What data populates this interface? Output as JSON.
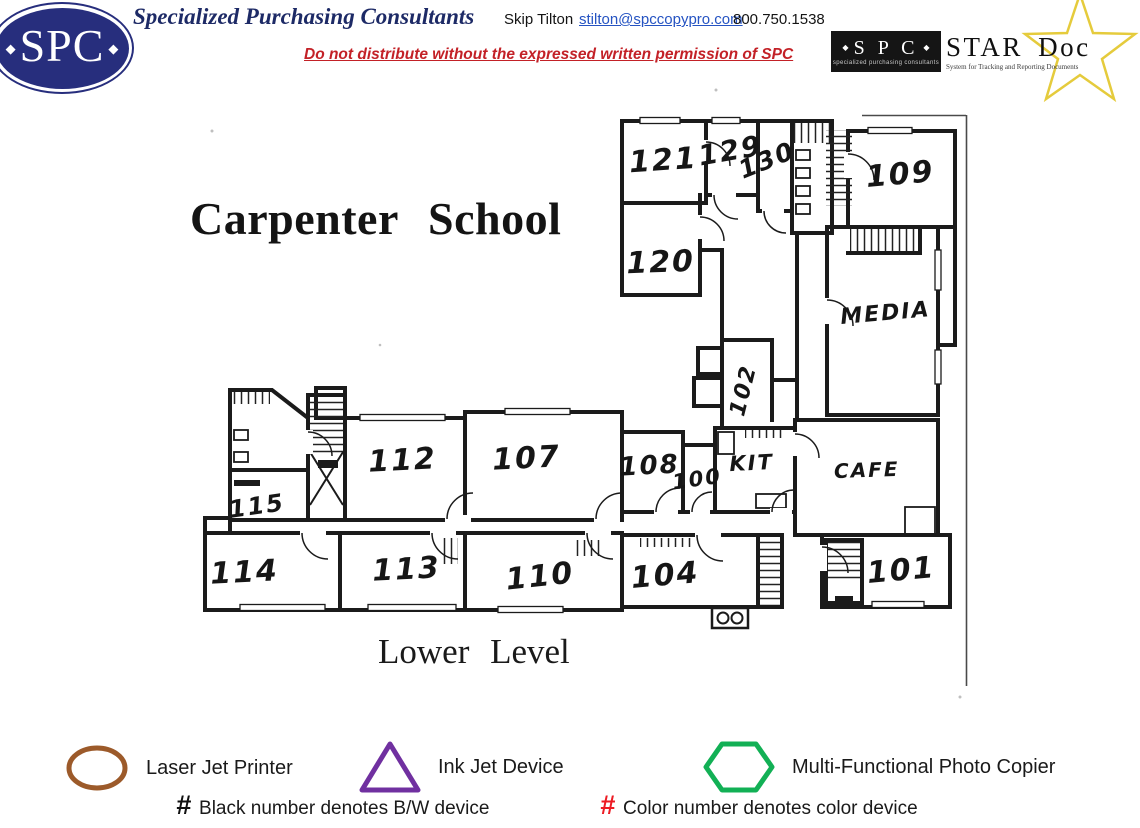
{
  "header": {
    "logo_text": "SPC",
    "company": "Specialized Purchasing Consultants",
    "contact": {
      "name": "Skip Tilton",
      "email": "stilton@spccopypro.com",
      "phone": "800.750.1538"
    },
    "warning": "Do not distribute without the expressed written permission of SPC",
    "stardoc": {
      "box_text": "S P C",
      "box_subtext": "specialized purchasing consultants",
      "title": "STAR Doc",
      "subtitle": "System for Tracking and Reporting Documents",
      "star_color": "#e5cb3c"
    }
  },
  "floorplan": {
    "title": "Carpenter School",
    "level": "Lower Level",
    "rooms": [
      {
        "label": "121",
        "x": 664,
        "y": 170,
        "rot": -4,
        "size": 30
      },
      {
        "label": "129",
        "x": 732,
        "y": 160,
        "rot": -10,
        "size": 28
      },
      {
        "label": "130",
        "x": 770,
        "y": 168,
        "rot": -22,
        "size": 25
      },
      {
        "label": "109",
        "x": 901,
        "y": 184,
        "rot": -5,
        "size": 30
      },
      {
        "label": "120",
        "x": 661,
        "y": 272,
        "rot": -2,
        "size": 30
      },
      {
        "label": "MEDIA",
        "x": 886,
        "y": 320,
        "rot": -5,
        "size": 22
      },
      {
        "label": "102",
        "x": 750,
        "y": 392,
        "rot": -76,
        "size": 22
      },
      {
        "label": "115",
        "x": 258,
        "y": 514,
        "rot": -8,
        "size": 24
      },
      {
        "label": "112",
        "x": 403,
        "y": 470,
        "rot": -3,
        "size": 30
      },
      {
        "label": "107",
        "x": 527,
        "y": 468,
        "rot": -3,
        "size": 30
      },
      {
        "label": "108",
        "x": 650,
        "y": 474,
        "rot": -3,
        "size": 26
      },
      {
        "label": "100",
        "x": 698,
        "y": 486,
        "rot": -8,
        "size": 21
      },
      {
        "label": "KIT",
        "x": 752,
        "y": 470,
        "rot": -3,
        "size": 21
      },
      {
        "label": "CAFE",
        "x": 867,
        "y": 477,
        "rot": -2,
        "size": 20
      },
      {
        "label": "114",
        "x": 245,
        "y": 582,
        "rot": -3,
        "size": 30
      },
      {
        "label": "113",
        "x": 407,
        "y": 579,
        "rot": -3,
        "size": 30
      },
      {
        "label": "110",
        "x": 541,
        "y": 586,
        "rot": -6,
        "size": 30
      },
      {
        "label": "104",
        "x": 666,
        "y": 585,
        "rot": -5,
        "size": 30
      },
      {
        "label": "101",
        "x": 902,
        "y": 580,
        "rot": -5,
        "size": 30
      }
    ]
  },
  "legend": {
    "items": [
      {
        "shape": "ellipse",
        "color": "#9c5a2a",
        "label": "Laser Jet Printer"
      },
      {
        "shape": "triangle",
        "color": "#7030a0",
        "label": "Ink Jet Device"
      },
      {
        "shape": "hexagon",
        "color": "#12b055",
        "label": "Multi-Functional Photo Copier"
      }
    ],
    "notes": [
      {
        "symbol": "#",
        "symbol_color": "#111111",
        "text": "Black number denotes B/W device"
      },
      {
        "symbol": "#",
        "symbol_color": "#ed1c24",
        "text": "Color number denotes color device"
      }
    ]
  }
}
